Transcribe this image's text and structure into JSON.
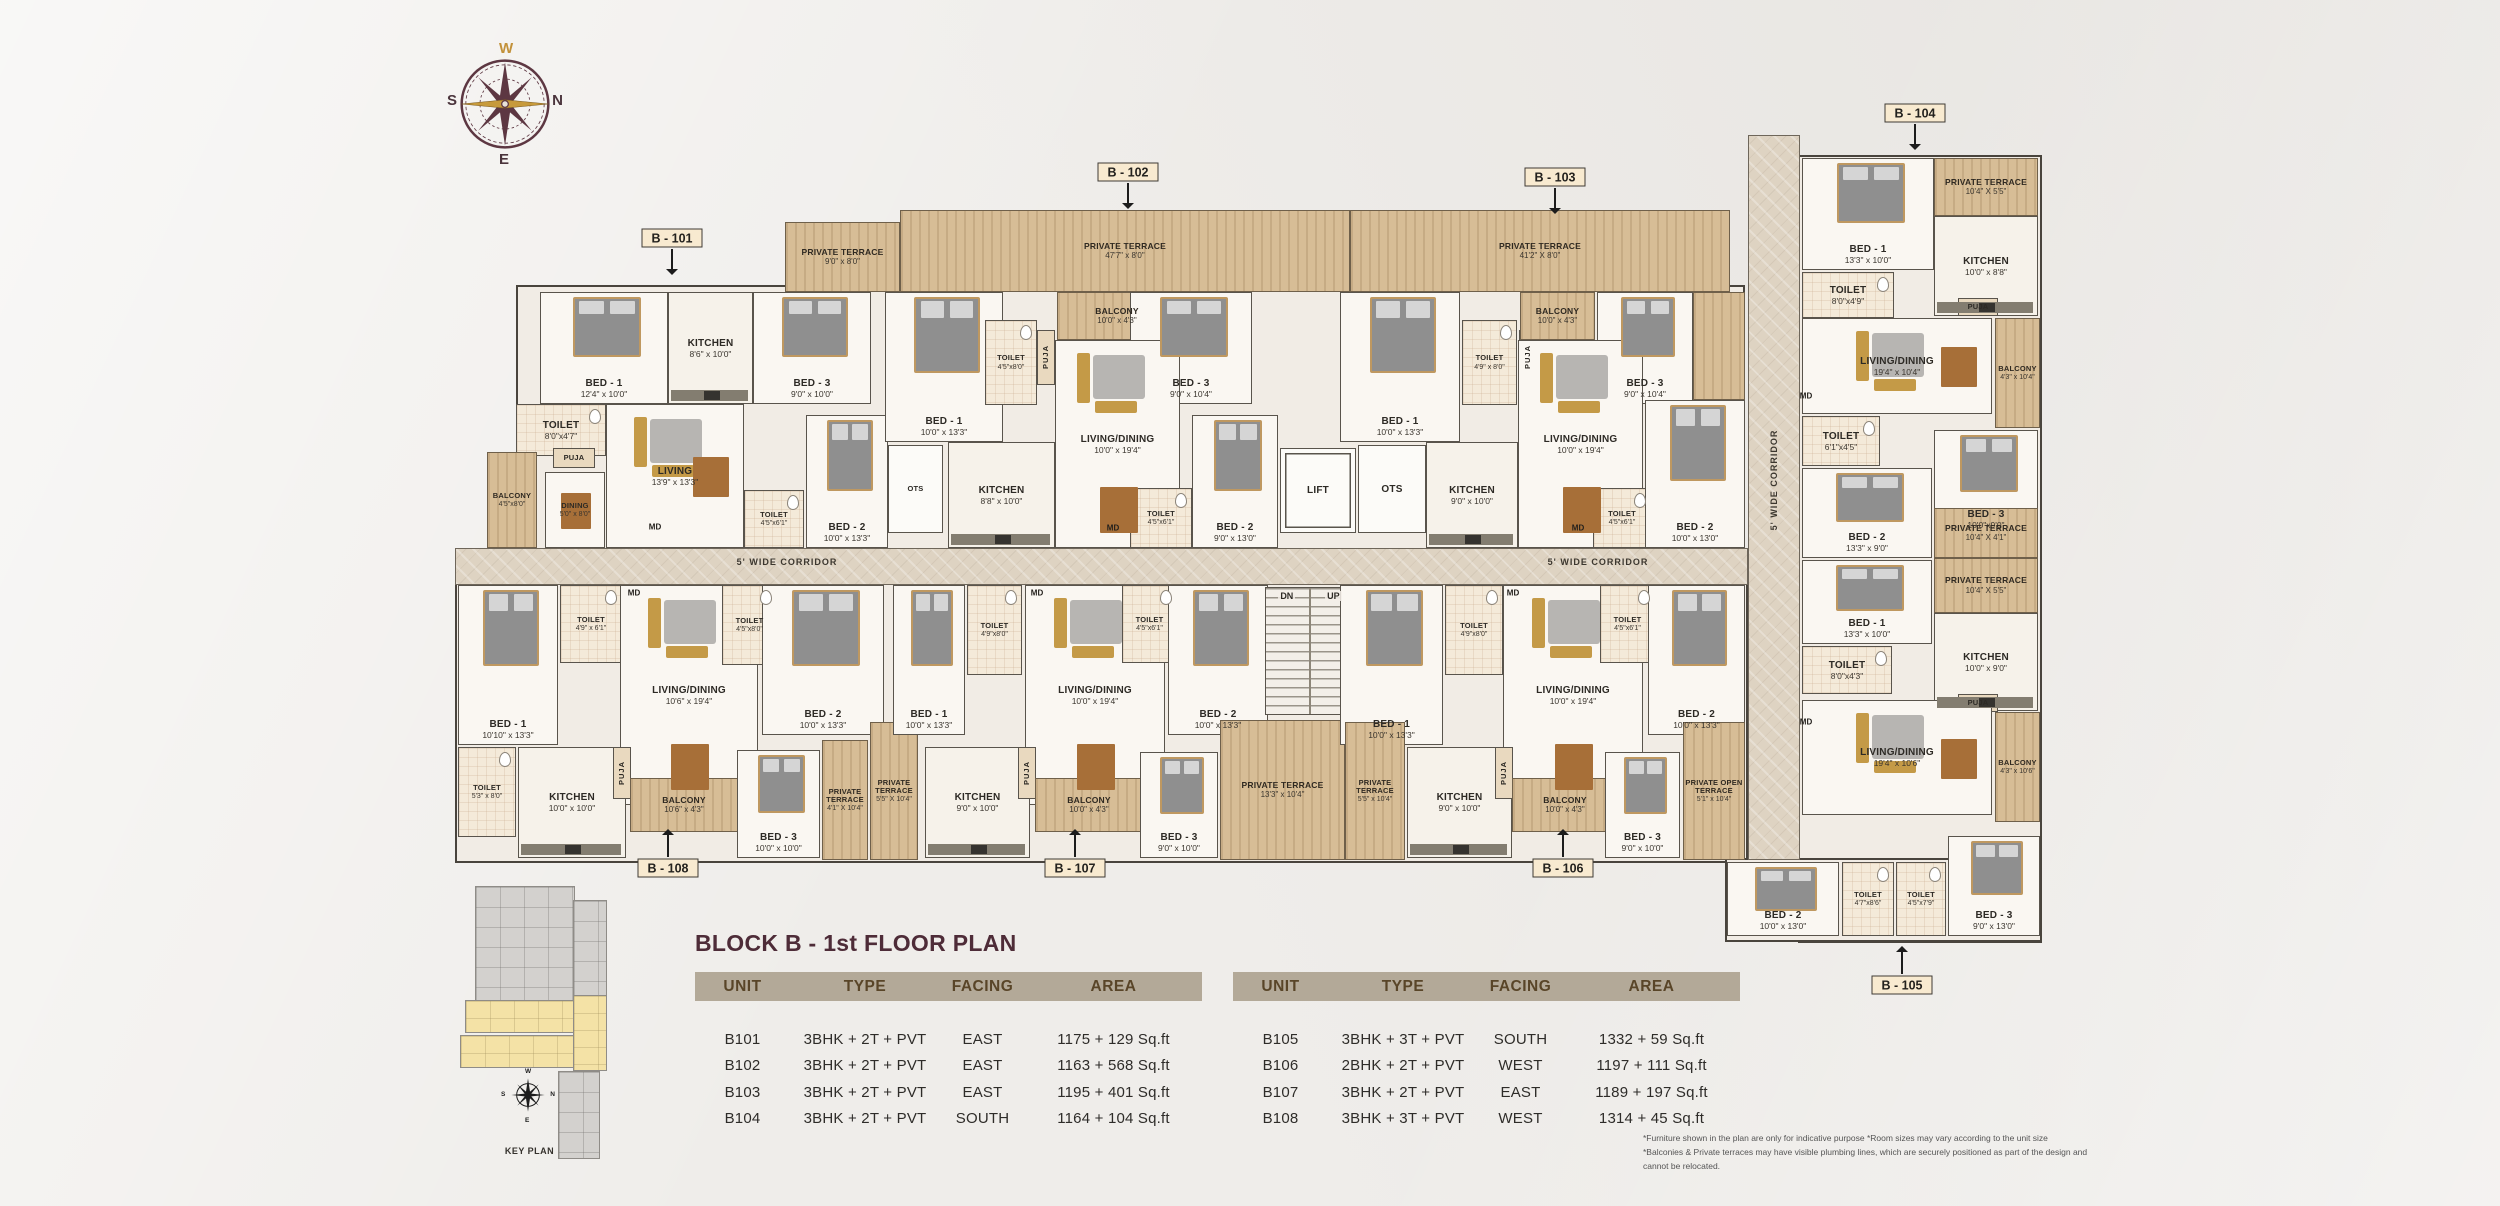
{
  "title": "BLOCK B - 1st FLOOR PLAN",
  "compass": {
    "top": "W",
    "right": "N",
    "bottom": "E",
    "left": "S"
  },
  "key_plan": {
    "label": "KEY PLAN"
  },
  "stairs": {
    "down_label": "DN",
    "up_label": "UP"
  },
  "corridors": [
    {
      "x": 455,
      "y": 548,
      "w": 1293,
      "h": 37,
      "dir": "h",
      "label": "5' WIDE CORRIDOR",
      "label_points": [
        [
          787,
          562
        ],
        [
          1598,
          562
        ]
      ]
    },
    {
      "x": 1748,
      "y": 135,
      "w": 52,
      "h": 725,
      "dir": "v",
      "label": "5' WIDE CORRIDOR",
      "label_points": [
        [
          1774,
          480
        ]
      ]
    }
  ],
  "blocks": [
    {
      "x": 516,
      "y": 285,
      "w": 1229,
      "h": 278
    },
    {
      "x": 455,
      "y": 580,
      "w": 1293,
      "h": 283
    },
    {
      "x": 1798,
      "y": 155,
      "w": 244,
      "h": 788
    },
    {
      "x": 1725,
      "y": 858,
      "w": 317,
      "h": 84
    }
  ],
  "rooms": [
    {
      "t": "terrace",
      "n": "PRIVATE TERRACE",
      "d": "9'0\" x 8'0\"",
      "x": 785,
      "y": 222,
      "w": 115,
      "h": 70
    },
    {
      "t": "terrace",
      "n": "PRIVATE TERRACE",
      "d": "47'7\" x 8'0\"",
      "x": 900,
      "y": 210,
      "w": 450,
      "h": 82
    },
    {
      "t": "terrace",
      "n": "PRIVATE TERRACE",
      "d": "41'2\" X 8'0\"",
      "x": 1350,
      "y": 210,
      "w": 380,
      "h": 82
    },
    {
      "t": "terrace",
      "n": "",
      "d": "",
      "x": 1693,
      "y": 292,
      "w": 52,
      "h": 108
    },
    {
      "t": "bed",
      "n": "BED - 1",
      "d": "12'4\" x 10'0\"",
      "x": 540,
      "y": 292,
      "w": 128,
      "h": 112
    },
    {
      "t": "kitchen",
      "n": "KITCHEN",
      "d": "8'6\" x 10'0\"",
      "x": 668,
      "y": 292,
      "w": 85,
      "h": 112
    },
    {
      "t": "bed",
      "n": "BED - 3",
      "d": "9'0\" x 10'0\"",
      "x": 753,
      "y": 292,
      "w": 118,
      "h": 112
    },
    {
      "t": "wet",
      "n": "TOILET",
      "d": "8'0\"x4'7\"",
      "x": 516,
      "y": 404,
      "w": 90,
      "h": 52
    },
    {
      "t": "living",
      "n": "LIVING",
      "d": "13'9\" x 13'3\"",
      "x": 606,
      "y": 404,
      "w": 138,
      "h": 144
    },
    {
      "t": "puja",
      "n": "PUJA",
      "d": "",
      "x": 553,
      "y": 448,
      "w": 42,
      "h": 20
    },
    {
      "t": "balc",
      "n": "BALCONY",
      "d": "4'5\"x8'0\"",
      "x": 487,
      "y": 452,
      "w": 50,
      "h": 96
    },
    {
      "t": "dining",
      "n": "DINING",
      "d": "5'0\" x 8'0\"",
      "x": 545,
      "y": 472,
      "w": 60,
      "h": 76
    },
    {
      "t": "wet",
      "n": "TOILET",
      "d": "4'5\"x6'1\"",
      "x": 744,
      "y": 490,
      "w": 60,
      "h": 58
    },
    {
      "t": "bed",
      "n": "BED - 2",
      "d": "10'0\" x 13'3\"",
      "x": 806,
      "y": 415,
      "w": 82,
      "h": 133
    },
    {
      "t": "ots",
      "n": "OTS",
      "d": "",
      "x": 888,
      "y": 445,
      "w": 55,
      "h": 88
    },
    {
      "t": "bed",
      "n": "BED - 1",
      "d": "10'0\" x 13'3\"",
      "x": 885,
      "y": 292,
      "w": 118,
      "h": 150
    },
    {
      "t": "wet",
      "n": "TOILET",
      "d": "4'5\"x8'0\"",
      "x": 985,
      "y": 320,
      "w": 52,
      "h": 85
    },
    {
      "t": "pujav",
      "n": "PUJA",
      "d": "",
      "x": 1037,
      "y": 330,
      "w": 18,
      "h": 55
    },
    {
      "t": "balc",
      "n": "BALCONY",
      "d": "10'0\" x 4'3\"",
      "x": 1057,
      "y": 292,
      "w": 120,
      "h": 48
    },
    {
      "t": "bed",
      "n": "BED - 3",
      "d": "9'0\" x 10'4\"",
      "x": 1130,
      "y": 292,
      "w": 122,
      "h": 112
    },
    {
      "t": "living",
      "n": "LIVING/DINING",
      "d": "10'0\" x 19'4\"",
      "x": 1055,
      "y": 340,
      "w": 125,
      "h": 208
    },
    {
      "t": "kitchen",
      "n": "KITCHEN",
      "d": "8'8\" x 10'0\"",
      "x": 948,
      "y": 442,
      "w": 107,
      "h": 106
    },
    {
      "t": "wet",
      "n": "TOILET",
      "d": "4'5\"x6'1\"",
      "x": 1130,
      "y": 488,
      "w": 62,
      "h": 60
    },
    {
      "t": "bed",
      "n": "BED - 2",
      "d": "9'0\" x 13'0\"",
      "x": 1192,
      "y": 415,
      "w": 86,
      "h": 133
    },
    {
      "t": "lift",
      "n": "LIFT",
      "d": "",
      "x": 1280,
      "y": 448,
      "w": 76,
      "h": 85
    },
    {
      "t": "ots",
      "n": "OTS",
      "d": "",
      "x": 1358,
      "y": 445,
      "w": 68,
      "h": 88
    },
    {
      "t": "bed",
      "n": "BED - 1",
      "d": "10'0\" x 13'3\"",
      "x": 1340,
      "y": 292,
      "w": 120,
      "h": 150
    },
    {
      "t": "wet",
      "n": "TOILET",
      "d": "4'9\" x 8'0\"",
      "x": 1462,
      "y": 320,
      "w": 55,
      "h": 85
    },
    {
      "t": "pujav",
      "n": "PUJA",
      "d": "",
      "x": 1519,
      "y": 330,
      "w": 18,
      "h": 55
    },
    {
      "t": "balc",
      "n": "BALCONY",
      "d": "10'0\" x 4'3\"",
      "x": 1520,
      "y": 292,
      "w": 75,
      "h": 48
    },
    {
      "t": "bed",
      "n": "BED - 3",
      "d": "9'0\" x 10'4\"",
      "x": 1597,
      "y": 292,
      "w": 96,
      "h": 112
    },
    {
      "t": "living",
      "n": "LIVING/DINING",
      "d": "10'0\" x 19'4\"",
      "x": 1518,
      "y": 340,
      "w": 125,
      "h": 208
    },
    {
      "t": "kitchen",
      "n": "KITCHEN",
      "d": "9'0\" x 10'0\"",
      "x": 1426,
      "y": 442,
      "w": 92,
      "h": 106
    },
    {
      "t": "wet",
      "n": "TOILET",
      "d": "4'5\"x6'1\"",
      "x": 1593,
      "y": 488,
      "w": 58,
      "h": 60
    },
    {
      "t": "bed",
      "n": "BED - 2",
      "d": "10'0\" x 13'0\"",
      "x": 1645,
      "y": 400,
      "w": 100,
      "h": 148
    },
    {
      "t": "bed",
      "n": "BED - 1",
      "d": "10'10\" x 13'3\"",
      "x": 458,
      "y": 585,
      "w": 100,
      "h": 160
    },
    {
      "t": "wet",
      "n": "TOILET",
      "d": "4'9\" x 6'1\"",
      "x": 560,
      "y": 585,
      "w": 62,
      "h": 78
    },
    {
      "t": "living",
      "n": "LIVING/DINING",
      "d": "10'6\" x 19'4\"",
      "x": 620,
      "y": 585,
      "w": 138,
      "h": 220
    },
    {
      "t": "wet",
      "n": "TOILET",
      "d": "4'5\"x8'0\"",
      "x": 722,
      "y": 585,
      "w": 55,
      "h": 80
    },
    {
      "t": "bed",
      "n": "BED - 2",
      "d": "10'0\" x 13'3\"",
      "x": 762,
      "y": 585,
      "w": 122,
      "h": 150
    },
    {
      "t": "wet",
      "n": "TOILET",
      "d": "5'3\" x 8'0\"",
      "x": 458,
      "y": 747,
      "w": 58,
      "h": 90
    },
    {
      "t": "kitchen",
      "n": "KITCHEN",
      "d": "10'0\" x 10'0\"",
      "x": 518,
      "y": 747,
      "w": 108,
      "h": 111
    },
    {
      "t": "pujav",
      "n": "PUJA",
      "d": "",
      "x": 613,
      "y": 747,
      "w": 18,
      "h": 52
    },
    {
      "t": "balc",
      "n": "BALCONY",
      "d": "10'6\" x 4'3\"",
      "x": 630,
      "y": 778,
      "w": 108,
      "h": 54
    },
    {
      "t": "bed",
      "n": "BED - 3",
      "d": "10'0\" x 10'0\"",
      "x": 737,
      "y": 750,
      "w": 83,
      "h": 108
    },
    {
      "t": "terrace",
      "n": "PRIVATE TERRACE",
      "d": "4'1\" X 10'4\"",
      "x": 822,
      "y": 740,
      "w": 46,
      "h": 120
    },
    {
      "t": "terrace",
      "n": "PRIVATE TERRACE",
      "d": "5'5\" X 10'4\"",
      "x": 870,
      "y": 722,
      "w": 48,
      "h": 138
    },
    {
      "t": "bed",
      "n": "BED - 1",
      "d": "10'0\" x 13'3\"",
      "x": 893,
      "y": 585,
      "w": 72,
      "h": 150
    },
    {
      "t": "wet",
      "n": "TOILET",
      "d": "4'9\"x8'0\"",
      "x": 967,
      "y": 585,
      "w": 55,
      "h": 90
    },
    {
      "t": "living",
      "n": "LIVING/DINING",
      "d": "10'0\" x 19'4\"",
      "x": 1025,
      "y": 585,
      "w": 140,
      "h": 220
    },
    {
      "t": "wet",
      "n": "TOILET",
      "d": "4'5\"x6'1\"",
      "x": 1122,
      "y": 585,
      "w": 55,
      "h": 78
    },
    {
      "t": "bed",
      "n": "BED - 2",
      "d": "10'0\" x 13'3\"",
      "x": 1168,
      "y": 585,
      "w": 100,
      "h": 150
    },
    {
      "t": "kitchen",
      "n": "KITCHEN",
      "d": "9'0\" x 10'0\"",
      "x": 925,
      "y": 747,
      "w": 105,
      "h": 111
    },
    {
      "t": "pujav",
      "n": "PUJA",
      "d": "",
      "x": 1018,
      "y": 747,
      "w": 18,
      "h": 52
    },
    {
      "t": "balc",
      "n": "BALCONY",
      "d": "10'0\" x 4'3\"",
      "x": 1035,
      "y": 778,
      "w": 108,
      "h": 54
    },
    {
      "t": "bed",
      "n": "BED - 3",
      "d": "9'0\" x 10'0\"",
      "x": 1140,
      "y": 752,
      "w": 78,
      "h": 106
    },
    {
      "t": "terrace",
      "n": "PRIVATE TERRACE",
      "d": "13'3\" x 10'4\"",
      "x": 1220,
      "y": 720,
      "w": 125,
      "h": 140
    },
    {
      "t": "stairs",
      "n": "",
      "d": "",
      "x": 1265,
      "y": 587,
      "w": 90,
      "h": 128
    },
    {
      "t": "bed",
      "n": "BED - 1",
      "d": "10'0\" x 13'3\"",
      "x": 1340,
      "y": 585,
      "w": 103,
      "h": 160
    },
    {
      "t": "wet",
      "n": "TOILET",
      "d": "4'9\"x8'0\"",
      "x": 1445,
      "y": 585,
      "w": 58,
      "h": 90
    },
    {
      "t": "living",
      "n": "LIVING/DINING",
      "d": "10'0\" x 19'4\"",
      "x": 1503,
      "y": 585,
      "w": 140,
      "h": 220
    },
    {
      "t": "wet",
      "n": "TOILET",
      "d": "4'5\"x6'1\"",
      "x": 1600,
      "y": 585,
      "w": 55,
      "h": 78
    },
    {
      "t": "bed",
      "n": "BED - 2",
      "d": "10'0\" x 13'3\"",
      "x": 1648,
      "y": 585,
      "w": 97,
      "h": 150
    },
    {
      "t": "terrace",
      "n": "PRIVATE TERRACE",
      "d": "5'5\" x 10'4\"",
      "x": 1345,
      "y": 722,
      "w": 60,
      "h": 138
    },
    {
      "t": "kitchen",
      "n": "KITCHEN",
      "d": "9'0\" x 10'0\"",
      "x": 1407,
      "y": 747,
      "w": 105,
      "h": 111
    },
    {
      "t": "pujav",
      "n": "PUJA",
      "d": "",
      "x": 1495,
      "y": 747,
      "w": 18,
      "h": 52
    },
    {
      "t": "balc",
      "n": "BALCONY",
      "d": "10'0\" x 4'3\"",
      "x": 1512,
      "y": 778,
      "w": 106,
      "h": 54
    },
    {
      "t": "bed",
      "n": "BED - 3",
      "d": "9'0\" x 10'0\"",
      "x": 1605,
      "y": 752,
      "w": 75,
      "h": 106
    },
    {
      "t": "terrace",
      "n": "PRIVATE OPEN TERRACE",
      "d": "5'1\" x 10'4\"",
      "x": 1683,
      "y": 722,
      "w": 62,
      "h": 138
    },
    {
      "t": "bed",
      "n": "BED - 1",
      "d": "13'3\" x 10'0\"",
      "x": 1802,
      "y": 158,
      "w": 132,
      "h": 112
    },
    {
      "t": "terrace",
      "n": "PRIVATE TERRACE",
      "d": "10'4\" X 5'5\"",
      "x": 1934,
      "y": 158,
      "w": 104,
      "h": 58
    },
    {
      "t": "kitchen",
      "n": "KITCHEN",
      "d": "10'0\" x 8'8\"",
      "x": 1934,
      "y": 216,
      "w": 104,
      "h": 100
    },
    {
      "t": "wet",
      "n": "TOILET",
      "d": "8'0\"x4'9\"",
      "x": 1802,
      "y": 272,
      "w": 92,
      "h": 46
    },
    {
      "t": "puja",
      "n": "PUJA",
      "d": "",
      "x": 1958,
      "y": 298,
      "w": 40,
      "h": 18
    },
    {
      "t": "balc",
      "n": "BALCONY",
      "d": "4'3\" x 10'4\"",
      "x": 1995,
      "y": 318,
      "w": 45,
      "h": 110
    },
    {
      "t": "living",
      "n": "LIVING/DINING",
      "d": "19'4\" x 10'4\"",
      "x": 1802,
      "y": 318,
      "w": 190,
      "h": 96
    },
    {
      "t": "wet",
      "n": "TOILET",
      "d": "6'1\"x4'5\"",
      "x": 1802,
      "y": 416,
      "w": 78,
      "h": 50
    },
    {
      "t": "bed",
      "n": "BED - 3",
      "d": "10'0\"x9'0\"",
      "x": 1934,
      "y": 430,
      "w": 104,
      "h": 105
    },
    {
      "t": "bed",
      "n": "BED - 2",
      "d": "13'3\" x 9'0\"",
      "x": 1802,
      "y": 468,
      "w": 130,
      "h": 90
    },
    {
      "t": "terrace",
      "n": "PRIVATE TERRACE",
      "d": "10'4\" X 4'1\"",
      "x": 1934,
      "y": 508,
      "w": 104,
      "h": 50
    },
    {
      "t": "terrace",
      "n": "PRIVATE TERRACE",
      "d": "10'4\" X 5'5\"",
      "x": 1934,
      "y": 558,
      "w": 104,
      "h": 55
    },
    {
      "t": "bed",
      "n": "BED - 1",
      "d": "13'3\" x 10'0\"",
      "x": 1802,
      "y": 560,
      "w": 130,
      "h": 84
    },
    {
      "t": "kitchen",
      "n": "KITCHEN",
      "d": "10'0\" x 9'0\"",
      "x": 1934,
      "y": 613,
      "w": 104,
      "h": 98
    },
    {
      "t": "wet",
      "n": "TOILET",
      "d": "8'0\"x4'3\"",
      "x": 1802,
      "y": 646,
      "w": 90,
      "h": 48
    },
    {
      "t": "puja",
      "n": "PUJA",
      "d": "",
      "x": 1958,
      "y": 694,
      "w": 40,
      "h": 18
    },
    {
      "t": "balc",
      "n": "BALCONY",
      "d": "4'3\" x 10'6\"",
      "x": 1995,
      "y": 712,
      "w": 45,
      "h": 110
    },
    {
      "t": "living",
      "n": "LIVING/DINING",
      "d": "19'4\" x 10'6\"",
      "x": 1802,
      "y": 700,
      "w": 190,
      "h": 115
    },
    {
      "t": "bed",
      "n": "BED - 2",
      "d": "10'0\" x 13'0\"",
      "x": 1727,
      "y": 862,
      "w": 112,
      "h": 74
    },
    {
      "t": "wet",
      "n": "TOILET",
      "d": "4'7\"x8'6\"",
      "x": 1842,
      "y": 862,
      "w": 52,
      "h": 74
    },
    {
      "t": "wet",
      "n": "TOILET",
      "d": "4'5\"x7'9\"",
      "x": 1896,
      "y": 862,
      "w": 50,
      "h": 74
    },
    {
      "t": "bed",
      "n": "BED - 3",
      "d": "9'0\" x 13'0\"",
      "x": 1948,
      "y": 836,
      "w": 92,
      "h": 100
    }
  ],
  "small_labels": [
    {
      "text": "MD",
      "x": 655,
      "y": 527
    },
    {
      "text": "MD",
      "x": 1113,
      "y": 528
    },
    {
      "text": "MD",
      "x": 1578,
      "y": 528
    },
    {
      "text": "MD",
      "x": 634,
      "y": 593
    },
    {
      "text": "MD",
      "x": 1037,
      "y": 593
    },
    {
      "text": "MD",
      "x": 1513,
      "y": 593
    },
    {
      "text": "MD",
      "x": 1806,
      "y": 396
    },
    {
      "text": "MD",
      "x": 1806,
      "y": 722
    }
  ],
  "unit_tags": [
    {
      "label": "B - 101",
      "x": 672,
      "y": 238,
      "dir": "down"
    },
    {
      "label": "B - 102",
      "x": 1128,
      "y": 172,
      "dir": "down"
    },
    {
      "label": "B - 103",
      "x": 1555,
      "y": 177,
      "dir": "down"
    },
    {
      "label": "B - 104",
      "x": 1915,
      "y": 113,
      "dir": "down"
    },
    {
      "label": "B - 105",
      "x": 1902,
      "y": 985,
      "dir": "up"
    },
    {
      "label": "B - 106",
      "x": 1563,
      "y": 868,
      "dir": "up"
    },
    {
      "label": "B - 107",
      "x": 1075,
      "y": 868,
      "dir": "up"
    },
    {
      "label": "B - 108",
      "x": 668,
      "y": 868,
      "dir": "up"
    }
  ],
  "tables": [
    {
      "headers": [
        "UNIT",
        "TYPE",
        "FACING",
        "AREA"
      ],
      "rows": [
        [
          "B101",
          "3BHK + 2T + PVT",
          "EAST",
          "1175 + 129 Sq.ft"
        ],
        [
          "B102",
          "3BHK + 2T + PVT",
          "EAST",
          "1163 + 568 Sq.ft"
        ],
        [
          "B103",
          "3BHK + 2T + PVT",
          "EAST",
          "1195 + 401 Sq.ft"
        ],
        [
          "B104",
          "3BHK + 2T + PVT",
          "SOUTH",
          "1164 + 104 Sq.ft"
        ]
      ]
    },
    {
      "headers": [
        "UNIT",
        "TYPE",
        "FACING",
        "AREA"
      ],
      "rows": [
        [
          "B105",
          "3BHK + 3T + PVT",
          "SOUTH",
          "1332 + 59 Sq.ft"
        ],
        [
          "B106",
          "2BHK + 2T + PVT",
          "WEST",
          "1197 + 111 Sq.ft"
        ],
        [
          "B107",
          "3BHK + 2T + PVT",
          "EAST",
          "1189 + 197 Sq.ft"
        ],
        [
          "B108",
          "3BHK + 3T + PVT",
          "WEST",
          "1314 + 45 Sq.ft"
        ]
      ]
    }
  ],
  "footnotes": [
    "*Furniture shown in the plan are only for indicative purpose *Room sizes may vary according to the unit size",
    "*Balconies & Private terraces may have visible plumbing lines, which are securely positioned as part of the design and cannot be relocated."
  ],
  "colors": {
    "title": "#4e2c38",
    "table_header_bg": "#b3a998",
    "table_header_text": "#594528",
    "tag_bg": "#f8ead0",
    "terrace_wood": "#d7bd96",
    "corridor": "#ded3c2",
    "compass_ring": "#5d3742",
    "compass_needle": "#c79a3b",
    "keyplan_highlight": "#f4e2a6"
  }
}
